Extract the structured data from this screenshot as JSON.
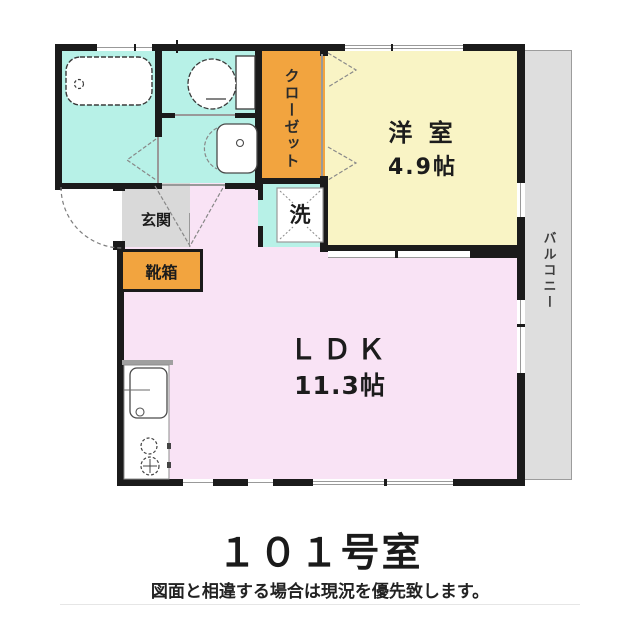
{
  "plan": {
    "unit_title": "１０１号室",
    "disclaimer": "図面と相違する場合は現況を優先致します。",
    "rooms": {
      "western_room": {
        "label": "洋 室",
        "size": "4.9帖"
      },
      "ldk": {
        "label": "ＬＤＫ",
        "size": "11.3帖"
      },
      "closet": {
        "label": "クローゼット"
      },
      "balcony": {
        "label": "バルコニー"
      },
      "entrance": {
        "label": "玄関"
      },
      "shoe_box": {
        "label": "靴箱"
      },
      "laundry": {
        "label": "洗"
      }
    },
    "fixtures": [
      "bathtub",
      "toilet",
      "vanity-sink",
      "washing-machine-space",
      "kitchen-sink",
      "stove-burners",
      "entrance-door-arc",
      "closet-folding-doors"
    ]
  },
  "colors": {
    "wet": "#b7f1e7",
    "closet": "#f2a43f",
    "western": "#f9f4c5",
    "ldk": "#f9e3f5",
    "entry": "#d9d9d9",
    "balcony": "#dedede",
    "wall": "#1b1b1b",
    "line": "#999999"
  }
}
